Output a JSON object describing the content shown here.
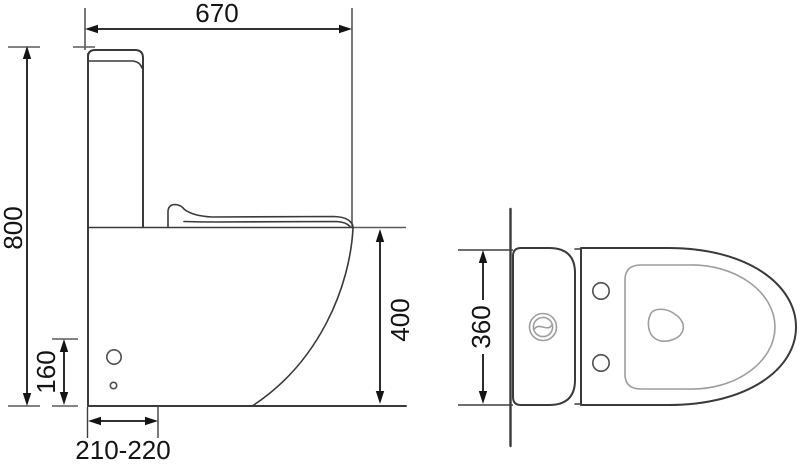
{
  "drawing": {
    "labels": {
      "overall_length": "670",
      "overall_height": "800",
      "inlet_height": "160",
      "outlet_distance": "210-220",
      "bowl_height": "400",
      "overall_width": "360"
    },
    "colors": {
      "outline": "#3a3a3a",
      "detail_gray": "#9e9e9e",
      "dimension": "#141414",
      "background": "#ffffff"
    }
  }
}
